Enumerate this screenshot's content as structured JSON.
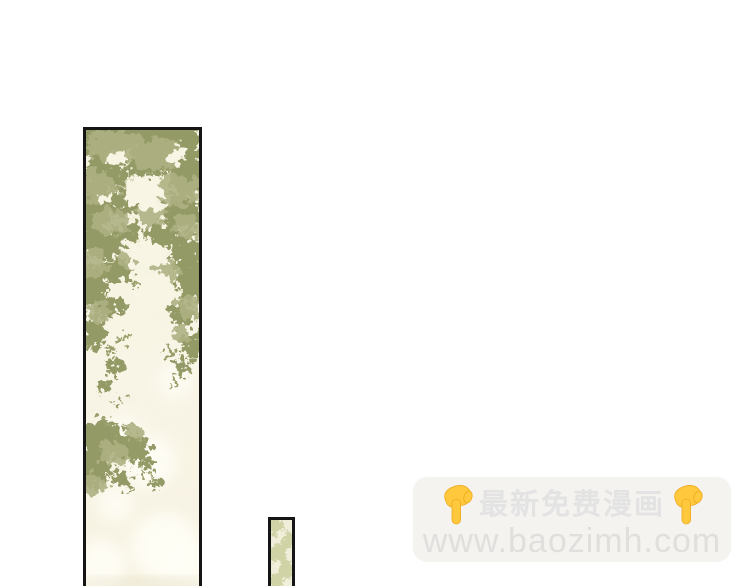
{
  "page": {
    "type": "comic-reader-page",
    "background_color": "#ffffff"
  },
  "panels": {
    "tall": {
      "description": "tall vertical comic panel of tree foliage with light shining through",
      "border_color": "#151515",
      "art_colors": {
        "foliage_green": "#a1a676",
        "foliage_green_dark": "#8f9660",
        "foliage_green_light": "#b3b789",
        "background_cream": "#f7f4e2",
        "bokeh_white": "#fffef6"
      }
    },
    "small": {
      "description": "narrow partial comic panel of pale foliage, cut off by page bottom",
      "border_color": "#151515",
      "art_colors": {
        "pale_green": "#ccd1a0",
        "background_cream": "#f0eedb"
      }
    }
  },
  "promo": {
    "background_color": "#f5f3f0",
    "headline": "最新免费漫画",
    "headline_color": "#e3e3e3",
    "website": "www.baozimh.com",
    "website_color": "#e0dfdd",
    "icons": {
      "left": "pointing-down-icon",
      "right": "pointing-down-icon",
      "hand_color": "#ffc83d"
    }
  }
}
